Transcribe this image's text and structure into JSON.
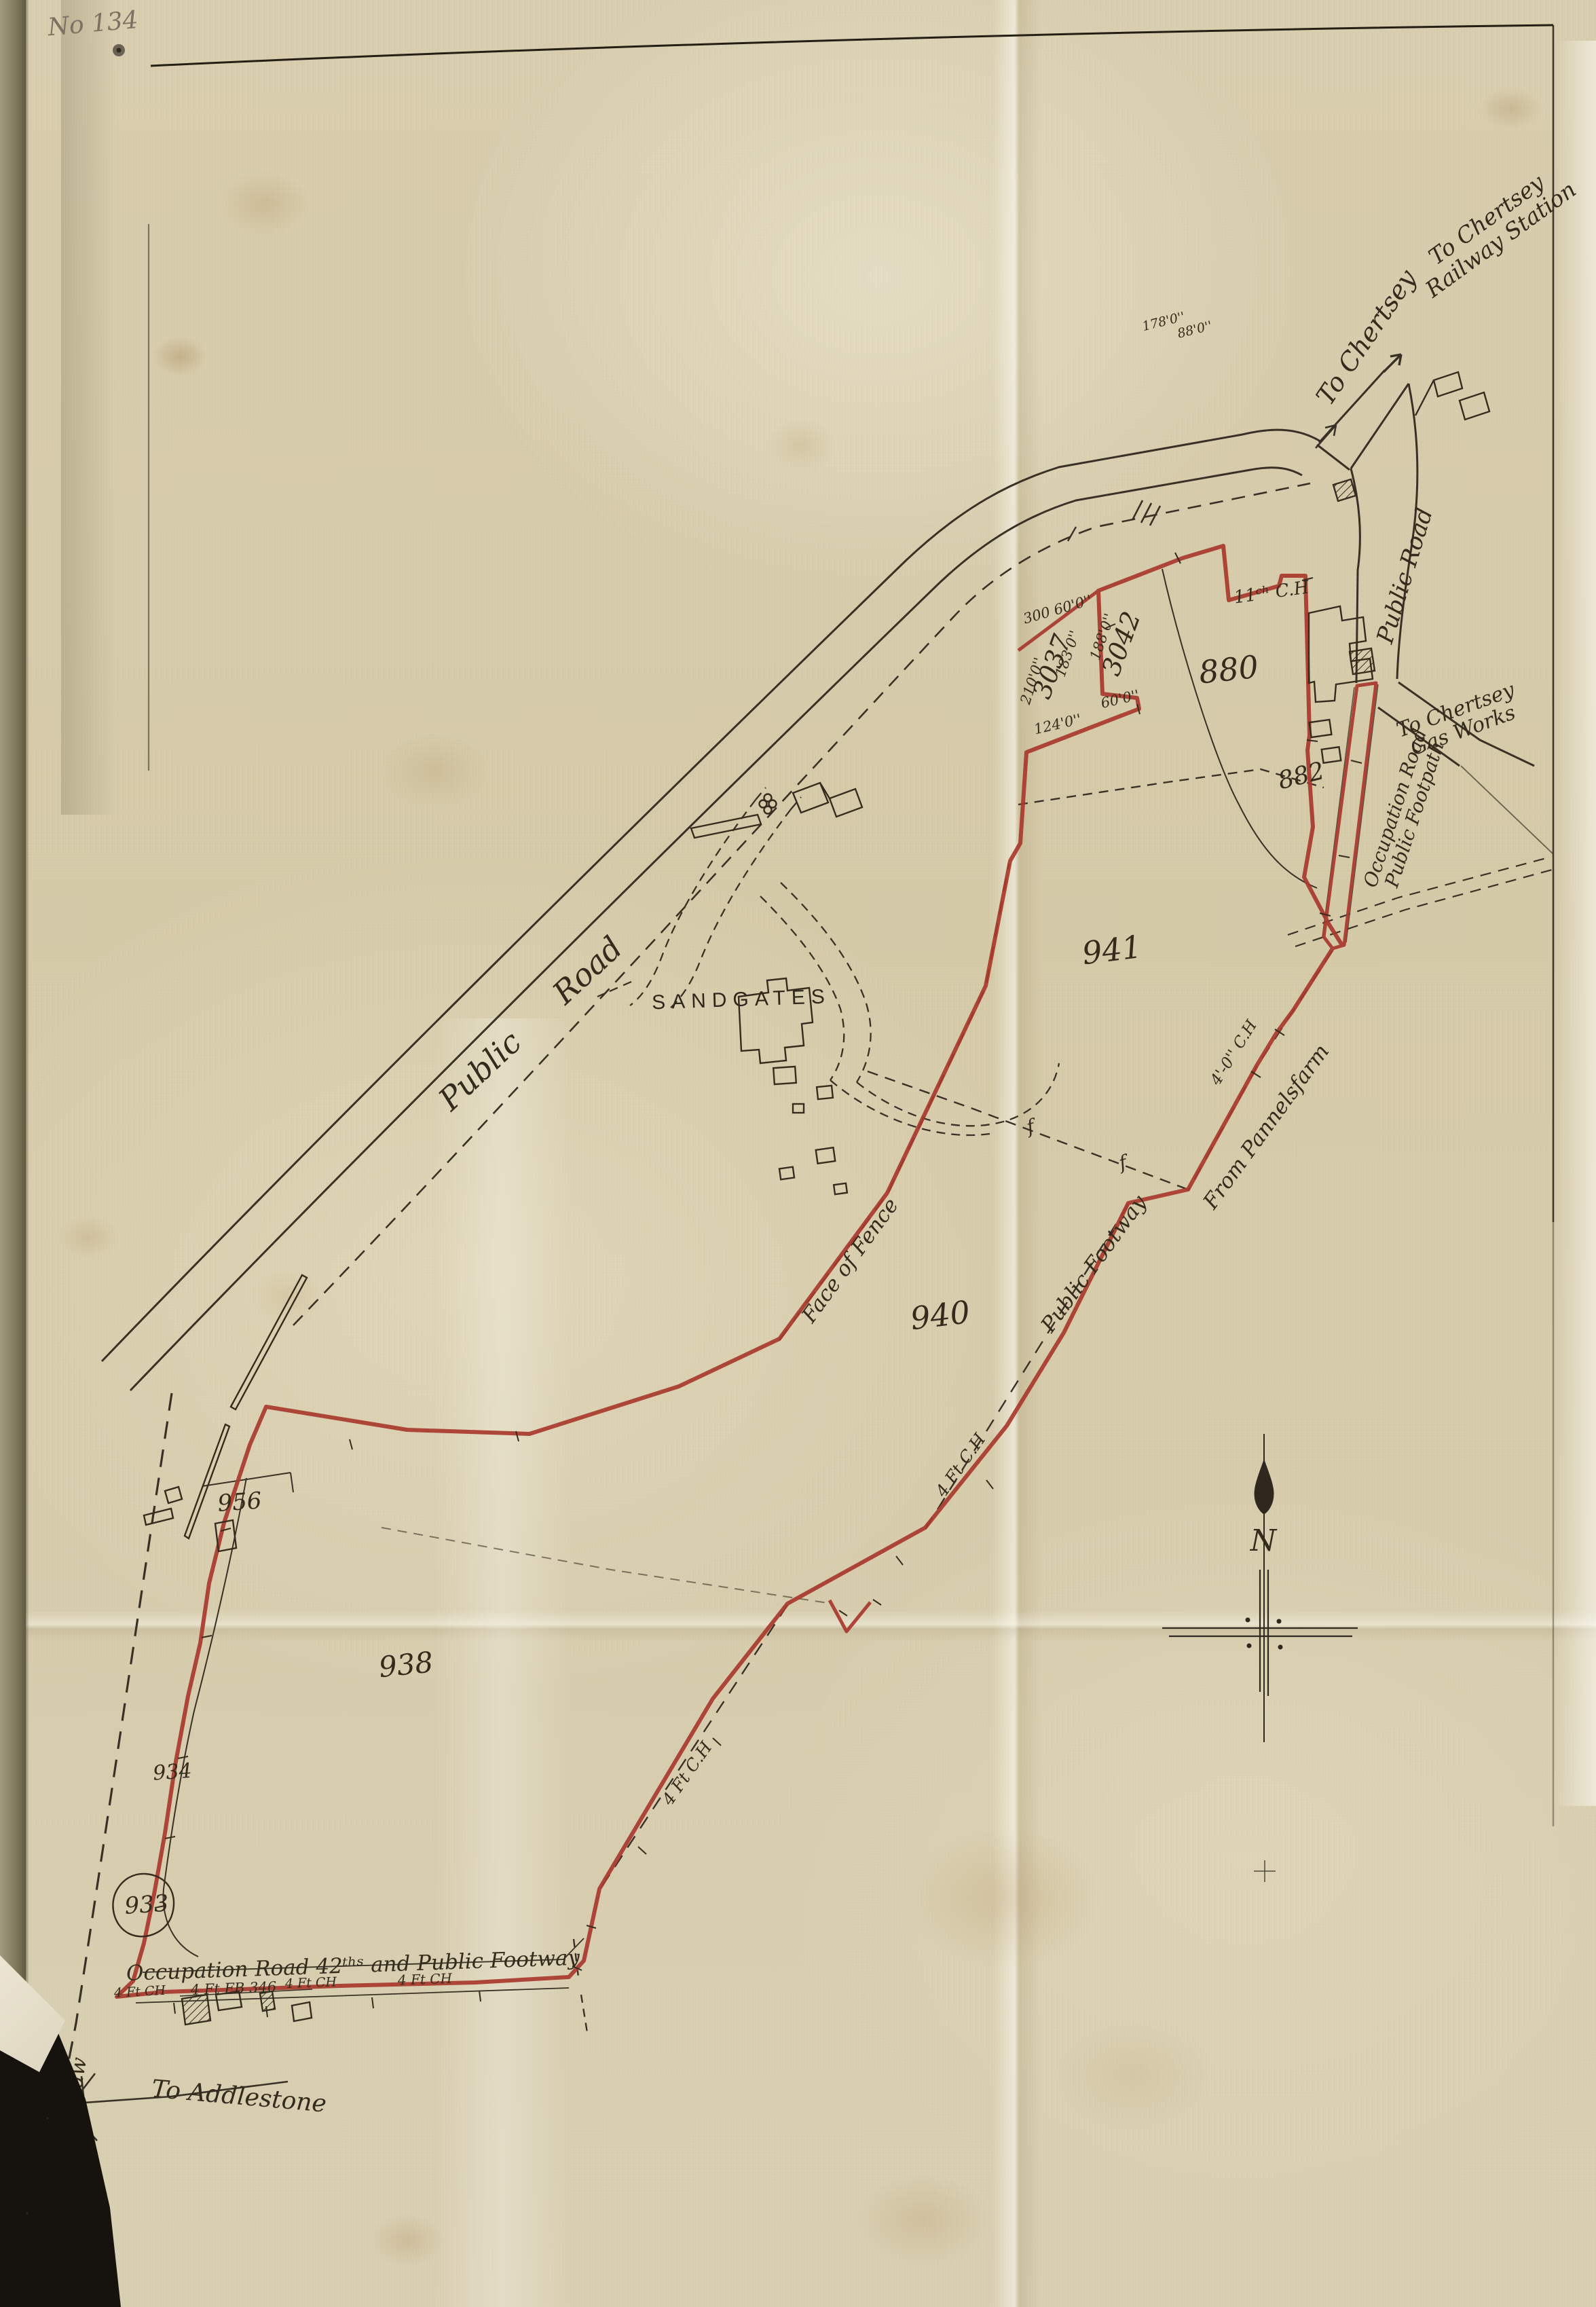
{
  "colors": {
    "paper": "#d6cbaa",
    "ink": "#342b1d",
    "boundary_red": "#a8392d",
    "pencil": "#7b7263"
  },
  "sheet": {
    "pencil_number": "No 134"
  },
  "labels": {
    "to_chertsey": "To Chertsey",
    "railway_line1": "To Chertsey",
    "railway_line2": "Railway Station",
    "public_road_main": "Public Road",
    "public_road_right": "Public Road",
    "gas_line1": "To Chertsey",
    "gas_line2": "Gas Works",
    "occ_fp_line1": "Occupation Road",
    "occ_fp_line2": "Public Footpath",
    "sandgates": "SANDGATES",
    "face_of_fence": "Face of Fence",
    "public_footway": "Public Footway",
    "from_pannelsfarm": "From Pannelsfarm",
    "from_ottershaw": "From Ottershaw",
    "to_addlestone": "To Addlestone",
    "occupation_road_42": "Occupation Road 42ᵗʰˢ and Public Footway",
    "ch_11": "11ᶜʰ C.H",
    "ch_40": "4'-0'' C.H",
    "ch_4ft_a": "4 Ft C.H",
    "ch_4ft_b": "4 Ft C.H",
    "fence_f1": "f",
    "fence_f2": "f",
    "compass_n": "N"
  },
  "plots": {
    "p3042": "3042",
    "p3037": "3037",
    "p880": "880",
    "p882": "882",
    "p941": "941",
    "p940": "940",
    "p956": "956",
    "p938": "938",
    "p934": "934",
    "p933": "933"
  },
  "measurements": {
    "m300_60": "300  60'0''",
    "m210": "210'0''",
    "m183": "183'0''",
    "m188": "188'0''",
    "m124": "124'0''",
    "m60b": "60'0''",
    "m178": "178'0''",
    "m88": "88'0''",
    "d1": "4 Ft CH",
    "d2": "4 Ft FB 346",
    "d3": "4 Ft CH",
    "d4": "4 Ft CH"
  }
}
